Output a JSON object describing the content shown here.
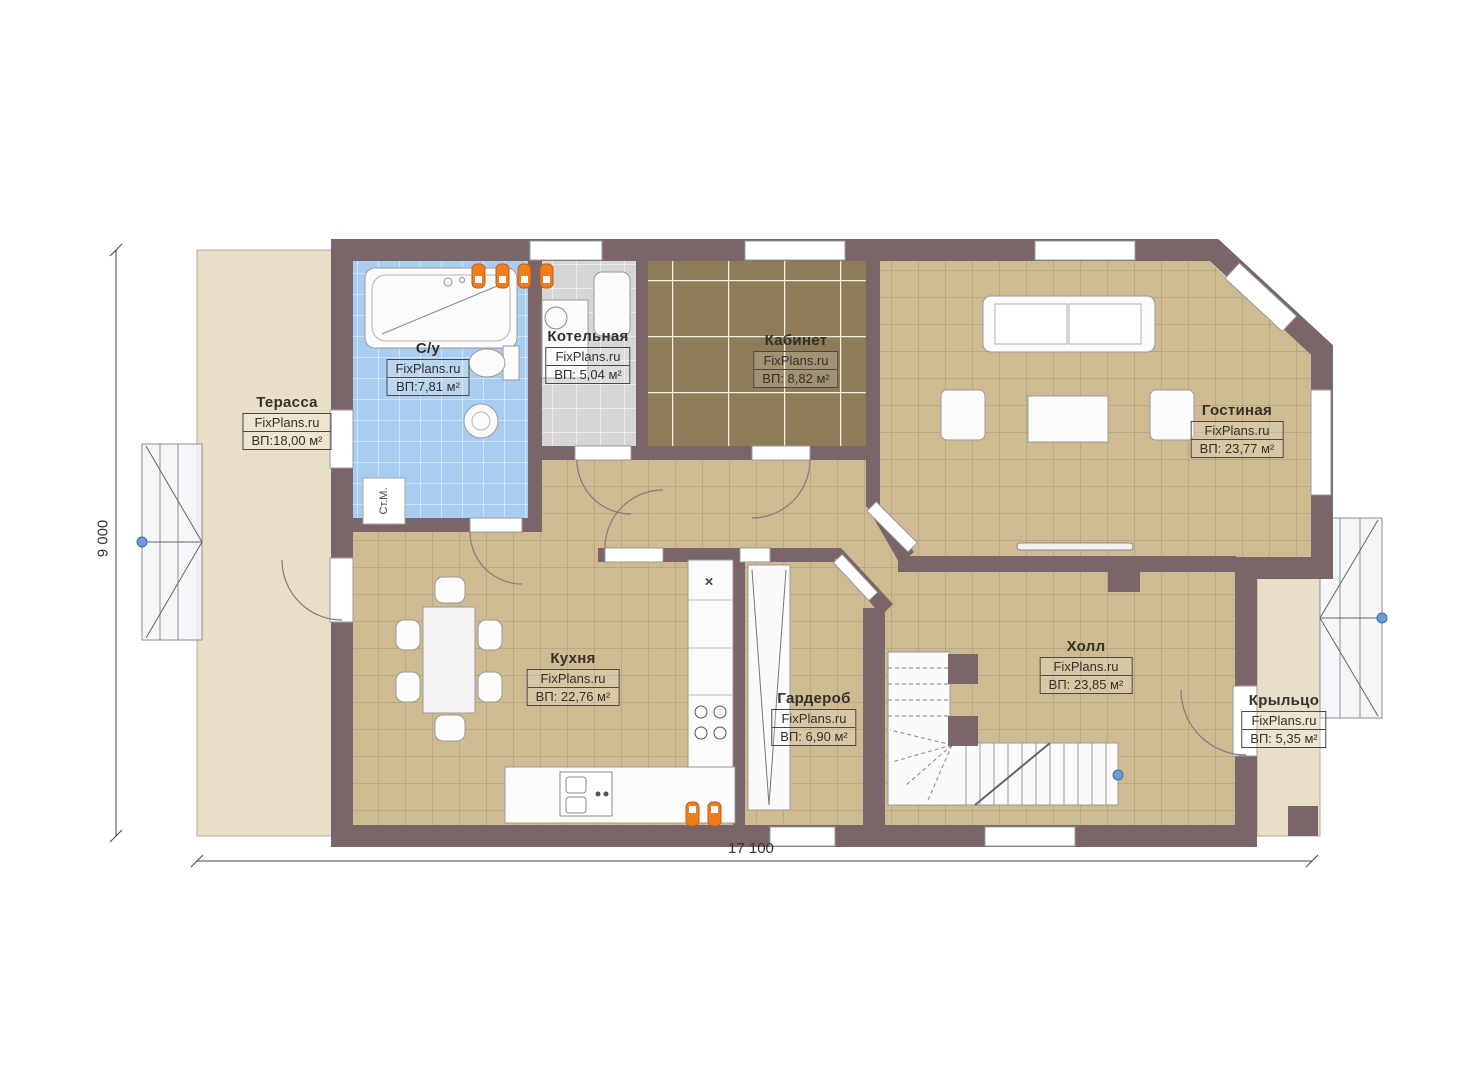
{
  "watermark": "FixPlans.ru",
  "dimensions": {
    "height_label": "9 000",
    "width_label": "17 100"
  },
  "rooms": [
    {
      "id": "terrace",
      "name": "Терасса",
      "area": "ВП:18,00 м²"
    },
    {
      "id": "bathroom",
      "name": "С/у",
      "area": "ВП:7,81 м²"
    },
    {
      "id": "boiler",
      "name": "Котельная",
      "area": "ВП: 5,04 м²"
    },
    {
      "id": "office",
      "name": "Кабинет",
      "area": "ВП: 8,82 м²"
    },
    {
      "id": "living",
      "name": "Гостиная",
      "area": "ВП: 23,77 м²"
    },
    {
      "id": "kitchen",
      "name": "Кухня",
      "area": "ВП: 22,76 м²"
    },
    {
      "id": "wardrobe",
      "name": "Гардероб",
      "area": "ВП: 6,90 м²"
    },
    {
      "id": "hall",
      "name": "Холл",
      "area": "ВП: 23,85 м²"
    },
    {
      "id": "porch",
      "name": "Крыльцо",
      "area": "ВП: 5,35 м²"
    }
  ],
  "appliances": {
    "washing_machine": "Ст.М.",
    "hob_symbol": "×"
  },
  "colors": {
    "wall": "#7a6568",
    "floor_tan": "#cfbb91",
    "floor_bath": "#a9cdf0",
    "floor_boiler": "#d6d6d6",
    "floor_office": "#8e7b57",
    "outdoor_beige": "#e9dfc8",
    "marker_orange": "#ed7d1d",
    "handle_blue": "#5b8fc9"
  }
}
